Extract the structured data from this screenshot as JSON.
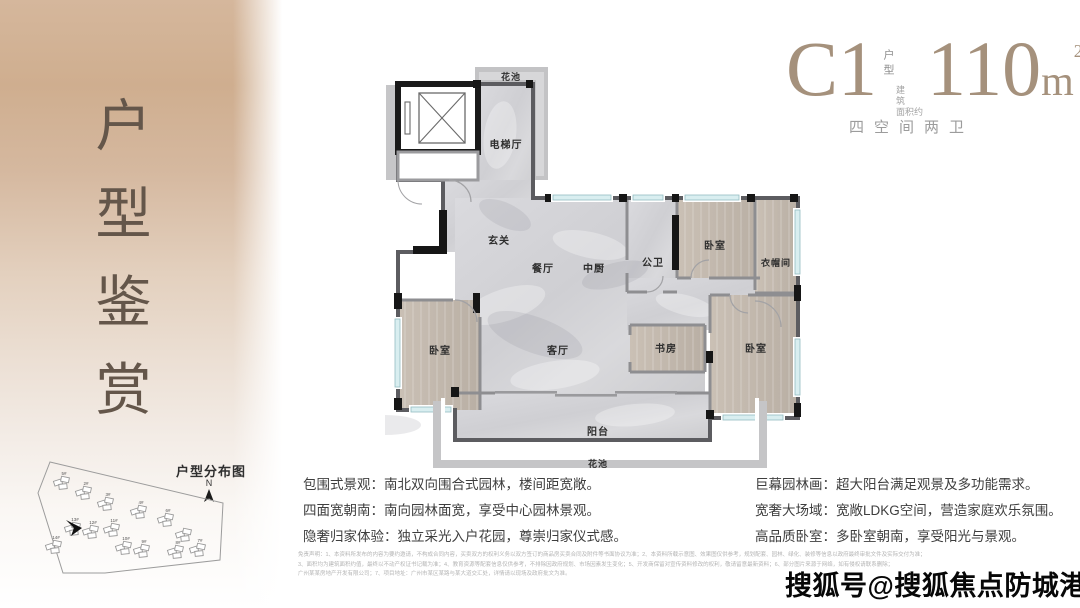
{
  "colors": {
    "sidebar_tan": "#cfae8f",
    "title_brown": "#64564a",
    "header_accent": "#a5917c",
    "marble_floor": "#d4d4d7",
    "wood_floor": "#c3b9ae",
    "wall_dark": "#161616",
    "window_glass": "#d9eef0",
    "feature_text": "#3e3e3e"
  },
  "sidebar": {
    "title": "户型鉴赏",
    "site_map": {
      "title": "户型分布图",
      "compass_n": "N",
      "buildings": [
        "5#",
        "2#",
        "3#",
        "4#",
        "6#",
        "7#",
        "8#",
        "9#",
        "10#",
        "11#",
        "12#",
        "13#",
        "14#"
      ]
    }
  },
  "header": {
    "unit_code": "C1",
    "unit_type_label": "户型",
    "area_label_line1": "建 筑",
    "area_label_line2": "面积约",
    "area_value": "110",
    "area_unit": "m",
    "area_sup": "2",
    "subtitle": "四空间两卫"
  },
  "floorplan": {
    "rooms": {
      "flower_bed_top": "花池",
      "elevator_hall": "电梯厅",
      "foyer": "玄关",
      "dining": "餐厅",
      "kitchen": "中厨",
      "bath": "公卫",
      "bedroom_ne": "卧室",
      "closet": "衣帽间",
      "living": "客厅",
      "study": "书房",
      "bedroom_w": "卧室",
      "bedroom_se": "卧室",
      "balcony": "阳台",
      "flower_bed_bottom": "花池"
    }
  },
  "features": {
    "left": [
      "包围式景观：南北双向围合式园林，楼间距宽敞。",
      "四面宽朝南：南向园林面宽，享受中心园林景观。",
      "隐奢归家体验：独立采光入户花园，尊崇归家仪式感。"
    ],
    "right": [
      "巨幕园林画：超大阳台满足观景及多功能需求。",
      "宽奢大场域：宽敞LDKG空间，营造家庭欢乐氛围。",
      "高品质卧室：多卧室朝南，享受阳光与景观。"
    ]
  },
  "disclaimer": {
    "lines": [
      "免责声明：1、本资料所发布的内容为要约邀请，不构成合同内容，买卖双方的权利义务以双方签订的商品房买卖合同及附件等书面协议为准；2、本资料所载示意图、效果图仅供参考，规划配套、园林、绿化、装修等信息以政府最终审批文件及实际交付为准；",
      "3、面积均为建筑面积约值，最终以不动产权证书记载为准；4、教育资源等配套信息仅供参考，不排除因政府规划、市场因素发生变化；5、开发商保留对宣传资料修改的权利，敬请留意最新资料；6、部分图片来源于网络，如有侵权请联系删除；",
      "广州某某房地产开发有限公司；7、项目地址：广州市某区某路与某大道交汇处，详情请以现场及政府批文为准。"
    ]
  },
  "watermark": {
    "text": "搜狐号@搜狐焦点防城港站"
  }
}
